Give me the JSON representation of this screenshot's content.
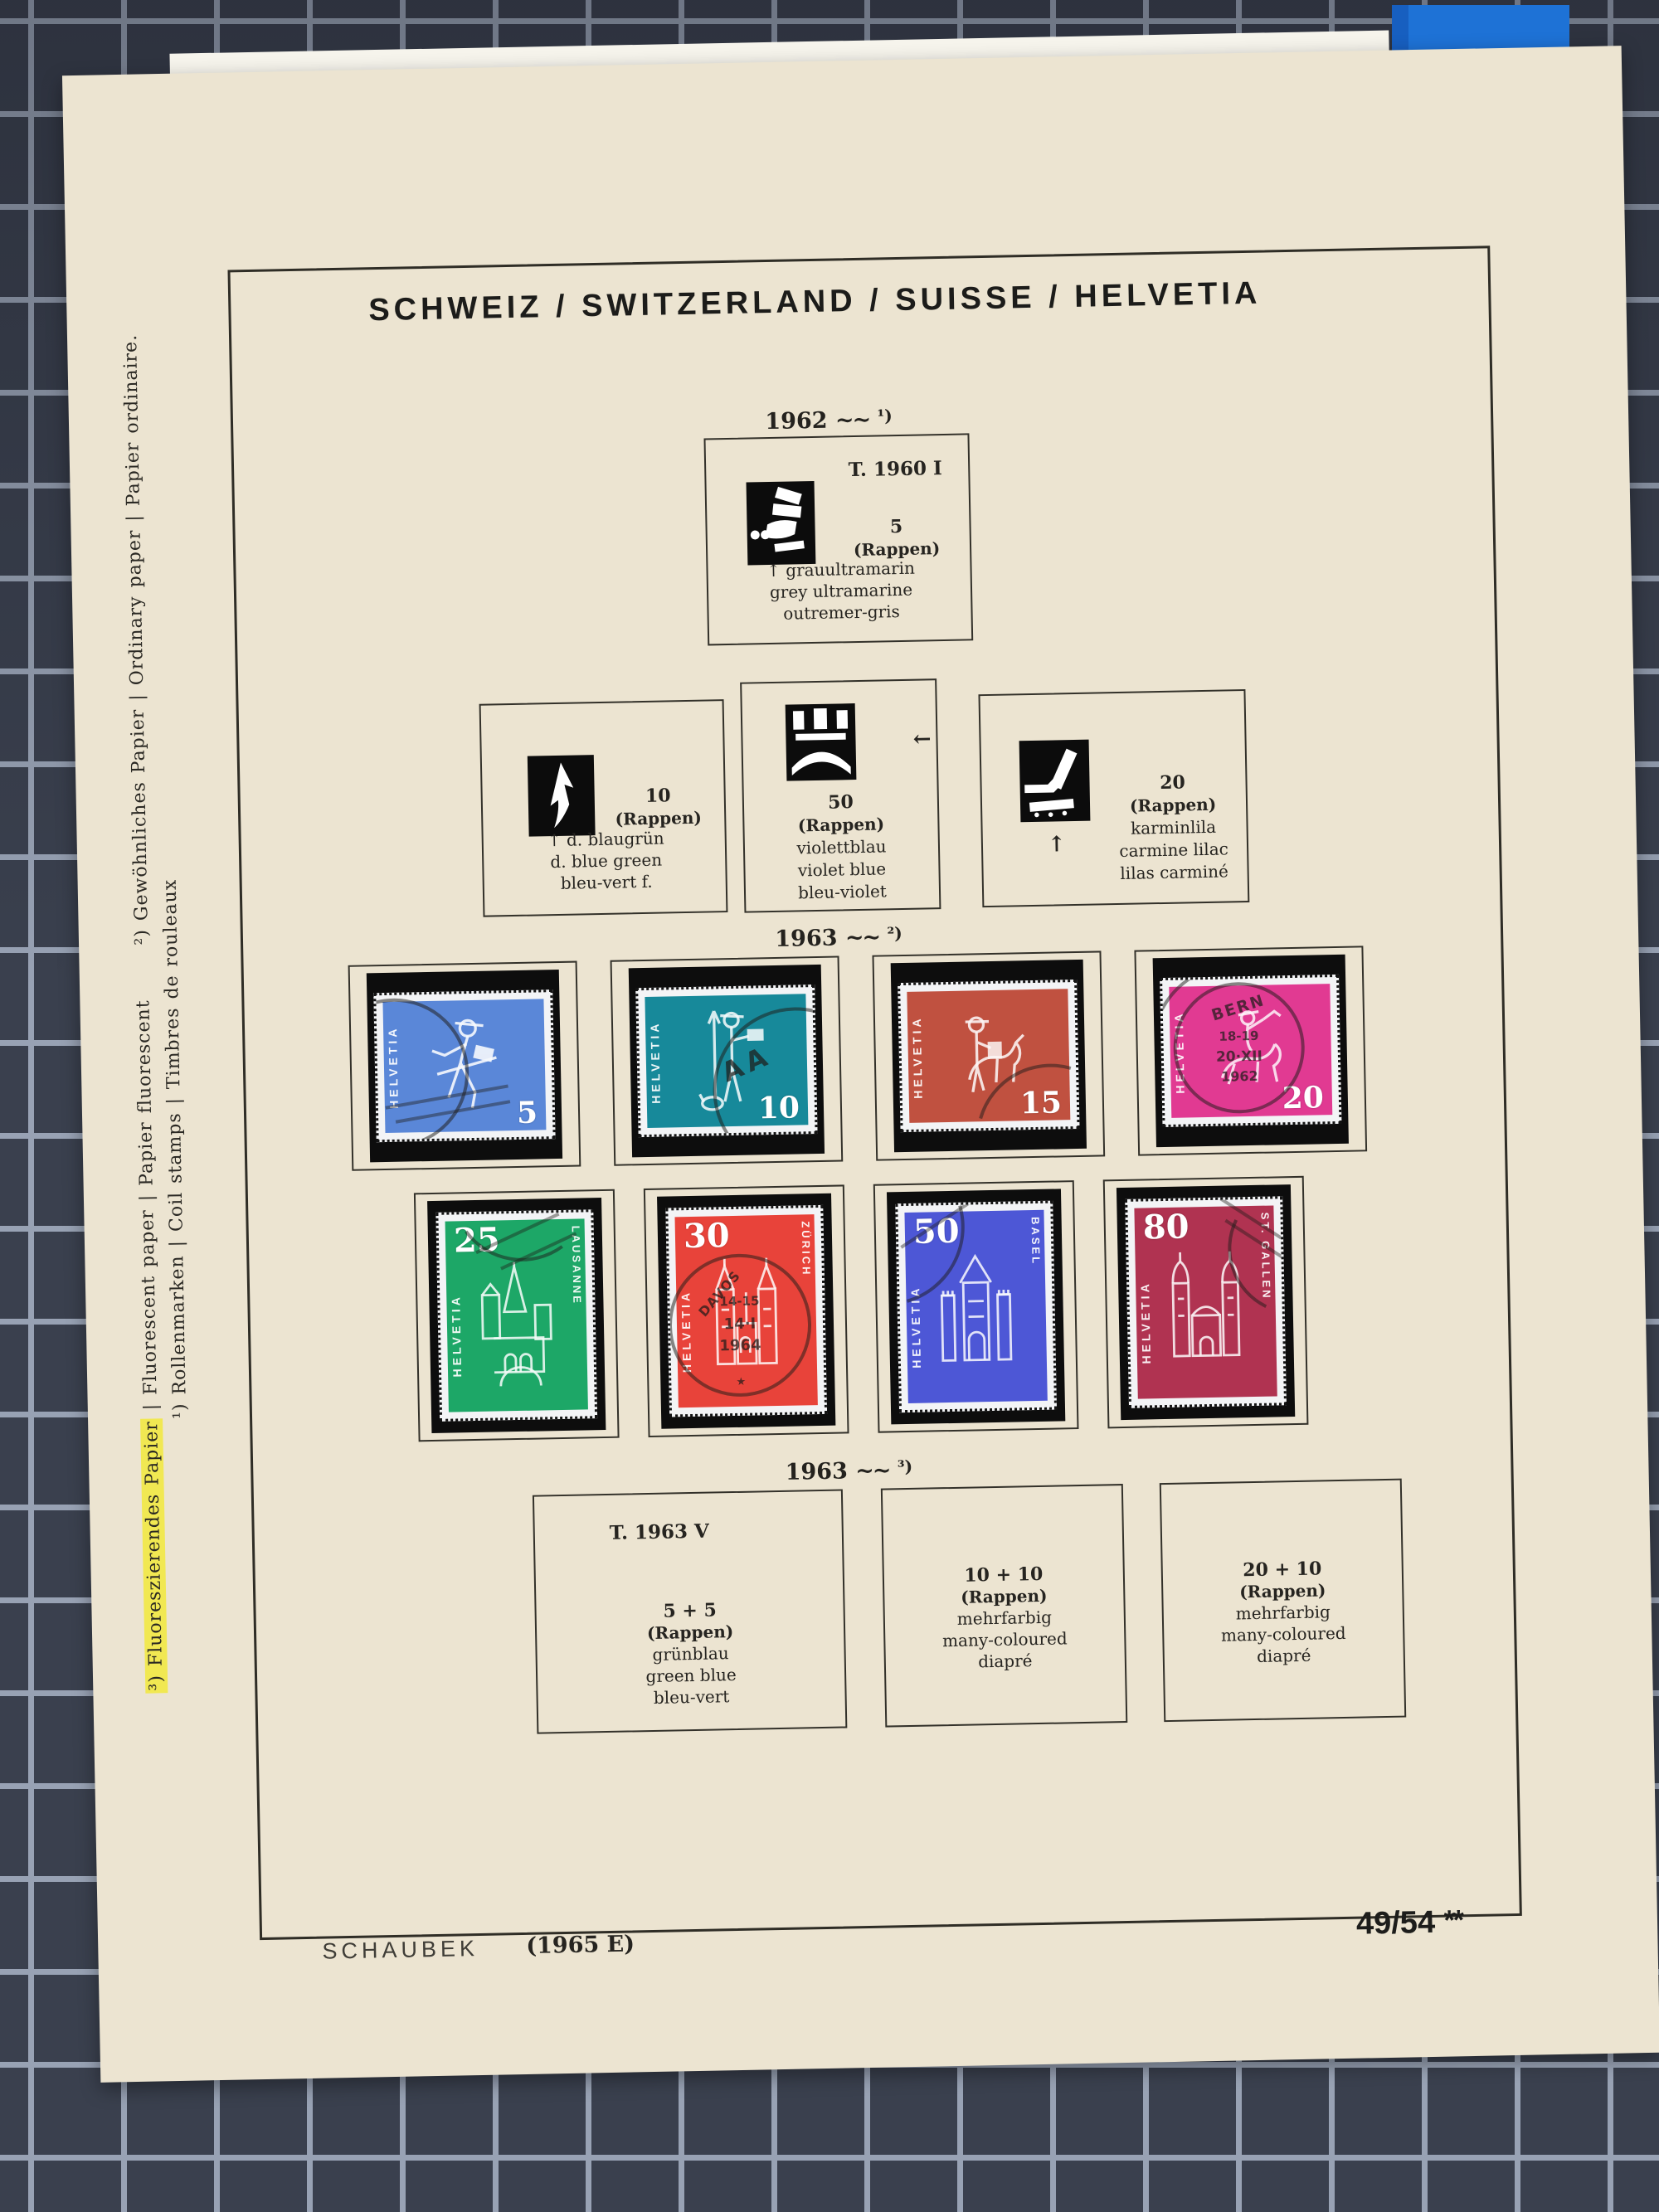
{
  "album_page": {
    "title": "SCHWEIZ / SWITZERLAND / SUISSE / HELVETIA",
    "publisher": "SCHAUBEK",
    "edition": "(1965 E)",
    "page_number": "49/54",
    "page_marks": "**"
  },
  "footnotes": {
    "coil": "¹) Rollenmarken | Coil stamps | Timbres de rouleaux",
    "fluorescent_highlighted": "³) Fluoreszierendes Papier",
    "fluorescent_rest": "| Fluorescent paper | Papier fluorescent",
    "ordinary": "²) Gewöhnliches Papier | Ordinary paper | Papier ordinaire."
  },
  "section_1962": {
    "year": "1962",
    "wave": "~~",
    "note": "¹)",
    "box_5": {
      "type_label": "T. 1960 I",
      "value": "5",
      "unit": "(Rappen)",
      "color_lines": [
        "↑ grauultramarin",
        "grey ultramarine",
        "outremer-gris"
      ]
    },
    "box_10": {
      "value": "10",
      "unit": "(Rappen)",
      "color_lines": [
        "↑ d. blaugrün",
        "d. blue green",
        "bleu-vert f."
      ]
    },
    "box_50": {
      "value": "50",
      "unit": "(Rappen)",
      "arrow": "←",
      "color_lines": [
        "violettblau",
        "violet blue",
        "bleu-violet"
      ]
    },
    "box_20": {
      "value": "20",
      "unit": "(Rappen)",
      "arrow": "↑",
      "color_lines": [
        "karminlila",
        "carmine lilac",
        "lilas carminé"
      ]
    }
  },
  "section_1963_ordinary": {
    "year": "1963",
    "wave": "~~",
    "note": "²)",
    "stamps": [
      {
        "country": "HELVETIA",
        "value": "5",
        "color": "#5a87d8",
        "motif": "running postal messenger"
      },
      {
        "country": "HELVETIA",
        "value": "10",
        "color": "#17899a",
        "motif": "standing messenger with spear and dog",
        "postmark": "AA"
      },
      {
        "country": "HELVETIA",
        "value": "15",
        "color": "#c05140",
        "motif": "postman with mule"
      },
      {
        "country": "HELVETIA",
        "value": "20",
        "color": "#e13a92",
        "motif": "post rider blowing horn",
        "postmark_lines": [
          "BERN",
          "18-19",
          "20·XII",
          "1962"
        ]
      },
      {
        "country": "HELVETIA",
        "value": "25",
        "city": "LAUSANNE",
        "color": "#1da767",
        "motif": "Lausanne cathedral"
      },
      {
        "country": "HELVETIA",
        "value": "30",
        "city": "ZÜRICH",
        "color": "#e8433a",
        "motif": "Zürich Grossmünster",
        "postmark_lines": [
          "DAVOS",
          "14-15",
          "14·I",
          "1964"
        ],
        "postmark_star": "★"
      },
      {
        "country": "HELVETIA",
        "value": "50",
        "city": "BASEL",
        "color": "#4d57d6",
        "motif": "Basel Spalentor gate"
      },
      {
        "country": "HELVETIA",
        "value": "80",
        "city": "ST. GALLEN",
        "color": "#b03351",
        "motif": "St. Gallen cathedral"
      }
    ]
  },
  "section_1963_fluorescent": {
    "year": "1963",
    "wave": "~~",
    "note": "³)",
    "box_a": {
      "type_label": "T. 1963 V",
      "value": "5 + 5",
      "unit": "(Rappen)",
      "color_lines": [
        "grünblau",
        "green blue",
        "bleu-vert"
      ]
    },
    "box_b": {
      "value": "10 + 10",
      "unit": "(Rappen)",
      "color_lines": [
        "mehrfarbig",
        "many-coloured",
        "diapré"
      ]
    },
    "box_c": {
      "value": "20 + 10",
      "unit": "(Rappen)",
      "color_lines": [
        "mehrfarbig",
        "many-coloured",
        "diapré"
      ]
    }
  }
}
